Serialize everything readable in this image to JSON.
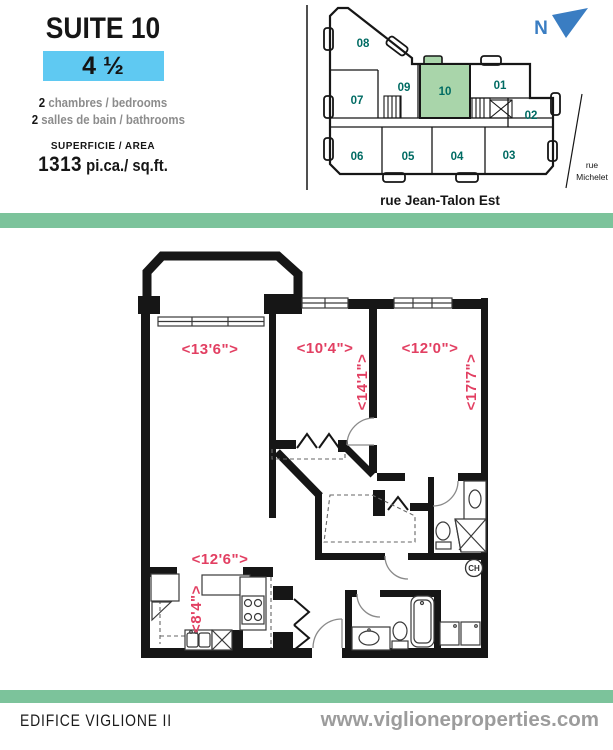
{
  "info_panel": {
    "suite_title": "SUITE 10",
    "unit_type": "4 ½",
    "specs": [
      {
        "count": "2",
        "label": "chambres / bedrooms"
      },
      {
        "count": "2",
        "label": "salles de bain / bathrooms"
      }
    ],
    "area_heading": "SUPERFICIE / AREA",
    "area_value": "1313",
    "area_unit": "pi.ca./ sq.ft."
  },
  "site_map": {
    "north_label": "N",
    "street_bottom": "rue Jean-Talon Est",
    "street_right": [
      "rue",
      "Michelet"
    ],
    "highlighted_unit": "10",
    "units": [
      "01",
      "02",
      "03",
      "04",
      "05",
      "06",
      "07",
      "08",
      "09",
      "10"
    ]
  },
  "floor_plan": {
    "dimensions": {
      "living_w": "<13'6\">",
      "bedroom2_w": "<10'4\">",
      "bedroom2_h": "<14'1\">",
      "bedroom3_w": "<12'0\">",
      "bedroom3_h": "<17'7\">",
      "kitchen_w": "<12'6\">",
      "kitchen_h": "<8'4\">"
    },
    "water_heater": "CH"
  },
  "footer": {
    "building_name": "EDIFICE VIGLIONE II",
    "website": "www.viglioneproperties.com"
  },
  "colors": {
    "accent_green": "#7cc39b",
    "highlight_blue": "#5fc9f2",
    "unit_fill_green": "#a9d5aa",
    "unit_number_teal": "#006b63",
    "dimension_red": "#e23f62",
    "north_blue": "#3a7dc2"
  }
}
